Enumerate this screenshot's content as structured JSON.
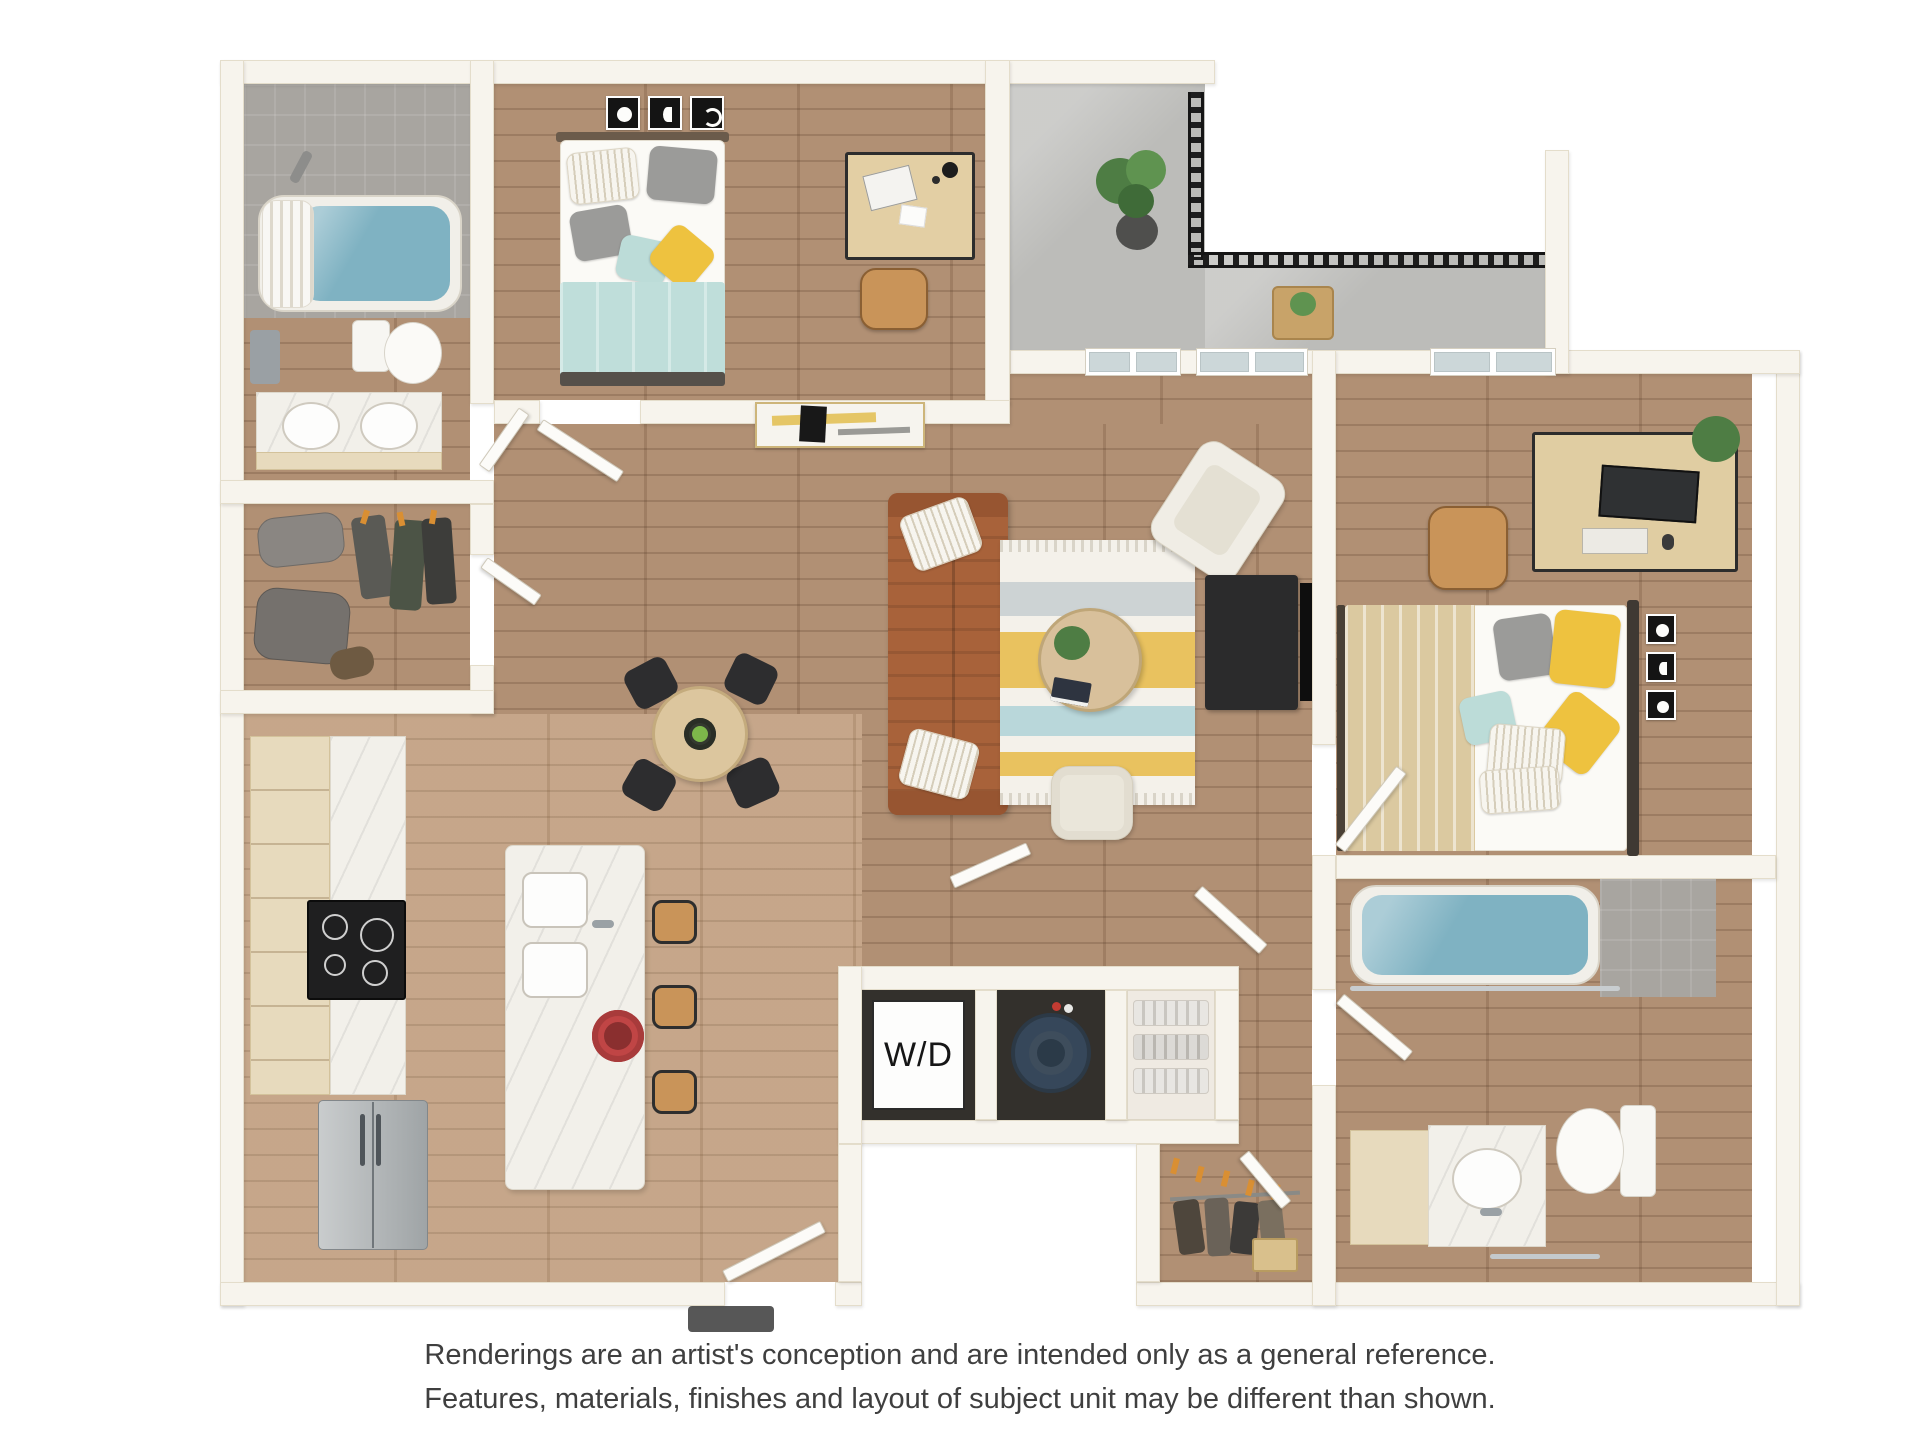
{
  "labels": {
    "washer_dryer": "W/D"
  },
  "disclaimer": {
    "line1": "Renderings are an artist's conception and are intended only as a general reference.",
    "line2": "Features, materials, finishes and layout of subject unit may be different than shown."
  },
  "colors": {
    "wall": "#f7f4ed",
    "wallEdge": "#e4ddcb",
    "wood": "#ad8a6d",
    "woodLight": "#c2a183",
    "tile": "#a8a5a0",
    "concrete": "#bcbcb9",
    "water": "#7fb2c2",
    "marble": "#f2f0ea",
    "cabinetWood": "#e7dabd",
    "sofaBrown": "#a8623a",
    "rugYellow": "#e9c25f",
    "rugTeal": "#b9d7da",
    "bedTeal": "#bcdcd8",
    "blanketTeal": "#bfdeda",
    "blanketTan": "#dbc9a0",
    "pillowYellow": "#eec23f",
    "pillowGray": "#9b9b99",
    "chairTan": "#c99459",
    "applianceDark": "#1f1f20",
    "navyTank": "#3e4d5c",
    "railBlack": "#1d1d1d",
    "plantGreen": "#4e7d44",
    "doorWhite": "#fcfbf8",
    "textGray": "#3f3f3f",
    "wdText": "#161616"
  }
}
